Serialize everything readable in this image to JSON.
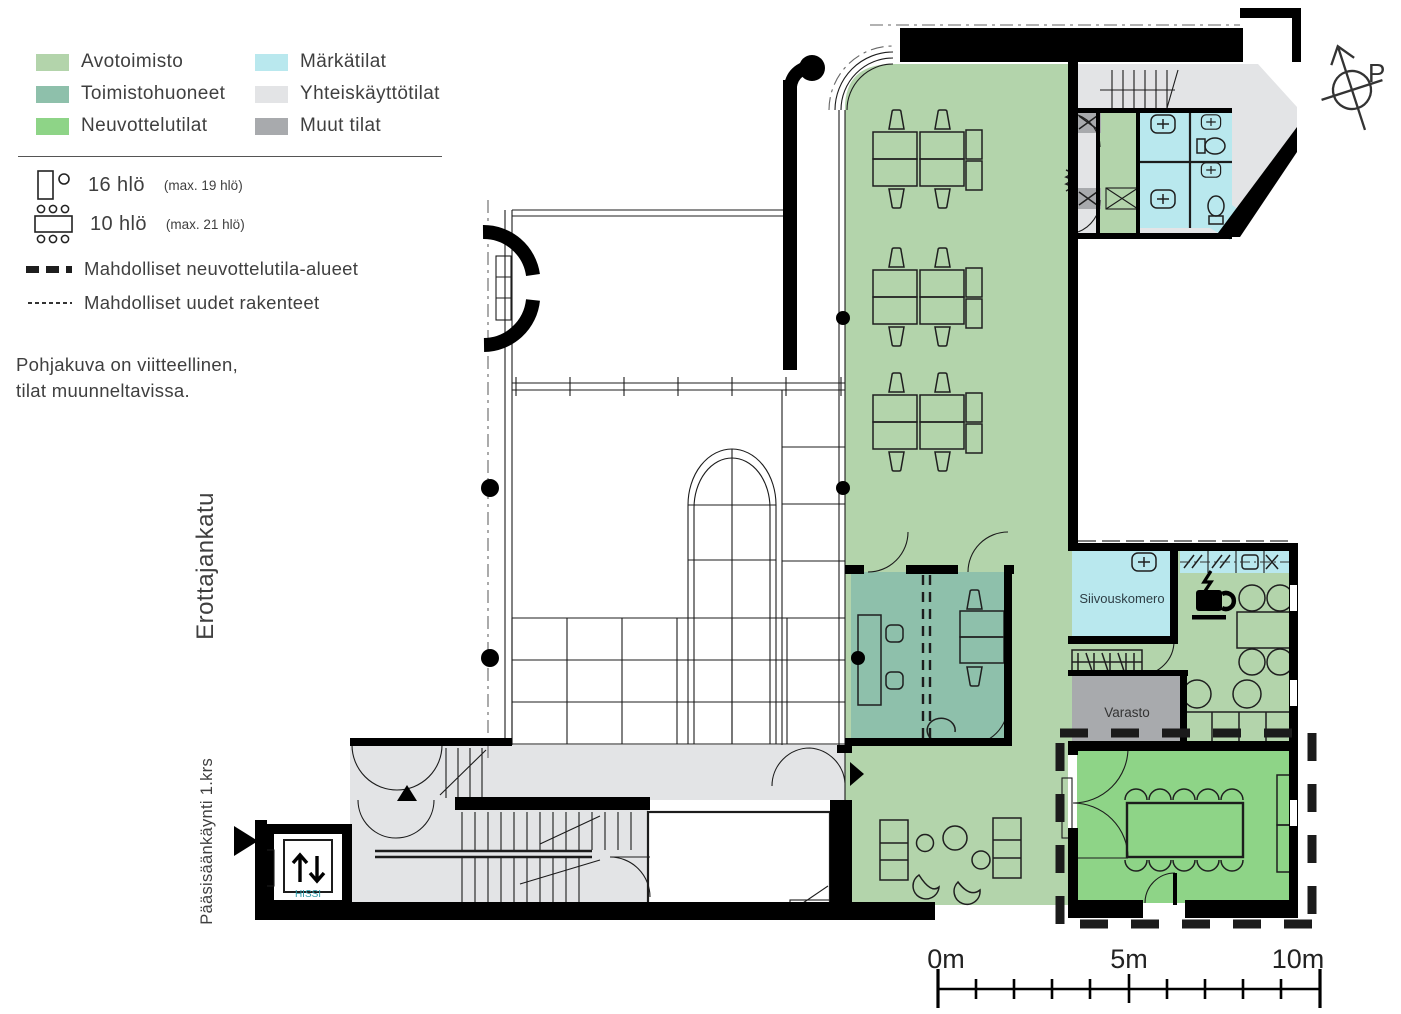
{
  "legend": {
    "areas": [
      {
        "label": "Avotoimisto",
        "color": "#b3d4ab"
      },
      {
        "label": "Toimistohuoneet",
        "color": "#8ec0ab"
      },
      {
        "label": "Neuvottelutilat",
        "color": "#8ed487"
      },
      {
        "label": "Märkätilat",
        "color": "#b9e8ee"
      },
      {
        "label": "Yhteiskäyttötilat",
        "color": "#e3e4e6"
      },
      {
        "label": "Muut tilat",
        "color": "#a8aaad"
      }
    ],
    "capacity": [
      {
        "people": "16 hlö",
        "max": "(max. 19 hlö)"
      },
      {
        "people": "10 hlö",
        "max": "(max. 21 hlö)"
      }
    ],
    "lines": [
      {
        "label": "Mahdolliset neuvottelutila-alueet"
      },
      {
        "label": "Mahdolliset uudet rakenteet"
      }
    ]
  },
  "note": {
    "line1": "Pohjakuva on viitteellinen,",
    "line2": "tilat muunneltavissa."
  },
  "labels": {
    "street": "Erottajankatu",
    "entrance": "Pääsisäänkäynti 1.krs",
    "compass": "P"
  },
  "rooms": {
    "cleaning_closet": "Siivouskomero",
    "storage": "Varasto",
    "elevator": "HISSI"
  },
  "scale_bar": {
    "start": "0m",
    "mid": "5m",
    "end": "10m"
  },
  "colors": {
    "open_office": "#b3d4ab",
    "office_rooms": "#8ec0ab",
    "meeting": "#8ed487",
    "wet": "#b9e8ee",
    "shared": "#e3e4e6",
    "other": "#a8aaad"
  }
}
